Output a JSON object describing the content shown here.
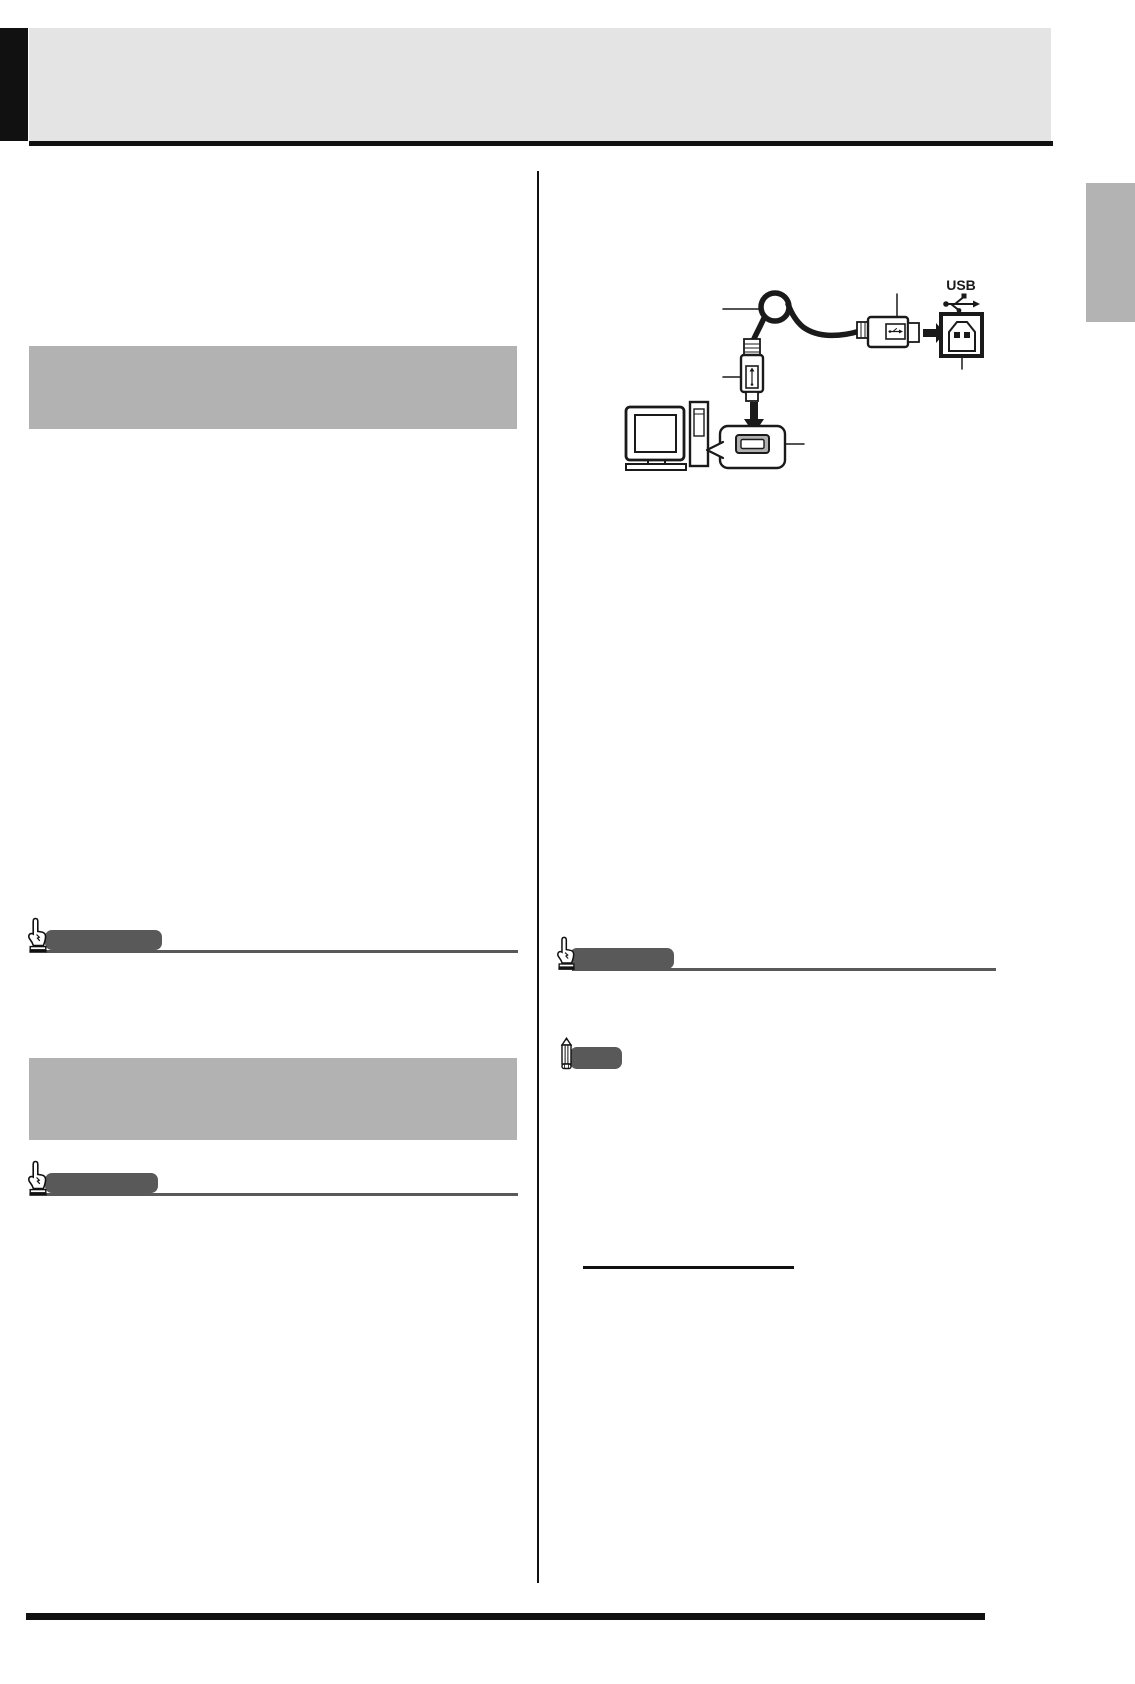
{
  "document": {
    "kind": "instruction-manual-page",
    "layout": "two-column",
    "visible_text": [
      "USB"
    ]
  },
  "colors": {
    "page_bg": "#ffffff",
    "ink": "#111111",
    "header_band": "#e4e4e4",
    "placeholder_gray": "#b2b2b2",
    "side_tab_gray": "#b3b3b3",
    "marker_gray": "#595959",
    "diagram_ink": "#1a1a1a"
  },
  "header": {
    "band": "blank-title-band",
    "corner": "black-corner-block"
  },
  "left_column": {
    "placeholder_boxes": 2,
    "markers": [
      {
        "icon": "pointing-hand-icon",
        "type": "important-marker"
      },
      {
        "icon": "pointing-hand-icon",
        "type": "important-marker"
      }
    ]
  },
  "right_column": {
    "markers": [
      {
        "icon": "pointing-hand-icon",
        "type": "important-marker"
      },
      {
        "icon": "pencil-icon",
        "type": "note-marker"
      }
    ],
    "link_underline": "blank-underlined-link",
    "diagram": {
      "usb_label": "USB",
      "icons": [
        "usb-trident-icon",
        "usb-b-port",
        "usb-a-connector",
        "usb-a-plug",
        "cable-coil",
        "right-arrow",
        "down-arrow",
        "computer",
        "usb-port-callout"
      ]
    }
  }
}
